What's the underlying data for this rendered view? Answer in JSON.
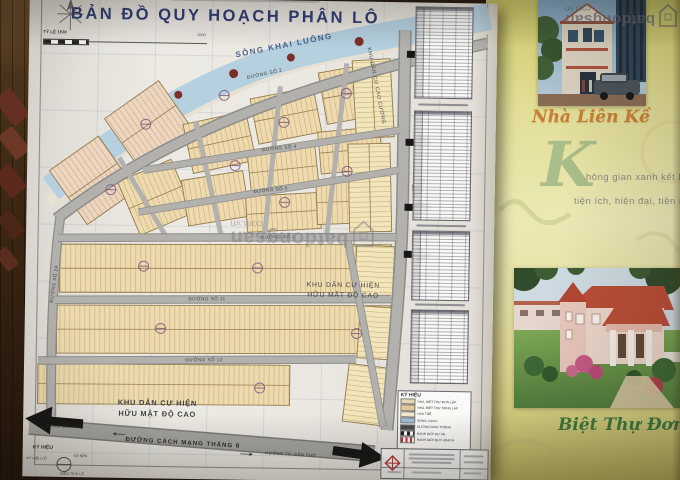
{
  "photo": {
    "watermark": {
      "brand": "batdongsan",
      "domain": "com.vn"
    }
  },
  "map": {
    "title": "BẢN ĐỒ QUY HOẠCH PHÂN LÔ",
    "scale_label": "TỶ LỆ 1KM",
    "scale_end": "1000",
    "river_label": "SÔNG KHAI LUÔNG",
    "roads": {
      "r2": "ĐƯỜNG SỐ 2",
      "r4": "ĐƯỜNG SỐ 4",
      "r5": "ĐƯỜNG SỐ 5",
      "r1": "ĐƯỜNG SỐ 1",
      "r11": "ĐƯỜNG SỐ 11",
      "r12": "ĐƯỜNG SỐ 12",
      "r2a": "ĐƯỜNG SỐ 2A",
      "cmt8": "ĐƯỜNG CÁCH MẠNG THÁNG 8"
    },
    "areas": {
      "cao_cuong": "KHU DÂN CƯ CAO CƯỜNG",
      "existing_line1": "KHU DÂN CƯ HIỆN",
      "existing_line2": "HỮU MẬT ĐỘ CAO"
    },
    "directions": {
      "port": "CẢNG CẦN THƠ",
      "port_arrow": "←",
      "city_arrow": "→",
      "city": "HƯỚNG TP. CẦN THƠ"
    },
    "legend": {
      "title": "KÝ HIỆU",
      "items": [
        {
          "label": "NHÀ, BIỆT THỰ ĐƠN LẬP",
          "color": "#e9d9b2"
        },
        {
          "label": "NHÀ, BIỆT THỰ SONG LẬP",
          "color": "#e2ca95"
        },
        {
          "label": "NHÀ TRẺ",
          "color": "#f3ecca"
        },
        {
          "label": "SÔNG, RẠCH",
          "color": "#9fc0d8"
        },
        {
          "label": "ĐƯỜNG GIAO THÔNG",
          "color": "#4a4a4a"
        },
        {
          "label": "RANH GIỚI DỰ ÁN",
          "color": "#222222"
        },
        {
          "label": "RANH GIỚI QUY HOẠCH",
          "color": "#c03030"
        }
      ]
    },
    "mini_legend": {
      "title": "KÝ HIỆU",
      "lot_code": "KÝ HIỆU LÔ",
      "lot_count": "SỐ NỀN",
      "lot_area": "DIỆN TÍCH LÔ"
    },
    "colors": {
      "title_text": "#2d3a78",
      "parcel_tan": "#f1dcab",
      "parcel_pink": "#f1d7bf",
      "river": "#b5d2e2",
      "road": "#b4b2ae"
    }
  },
  "brochure": {
    "card1_title": "Nhà Liên Kề",
    "drop_cap": "K",
    "tagline_line1": "hông gian xanh kết hợp hài hòa",
    "tagline_line2": "tiện ích, hiện đại, tiện nghi và gầ",
    "card2_title": "Biệt Thự Đơn L",
    "colors": {
      "card1_title": "#cf7f2e",
      "card2_title": "#3a7a3c"
    }
  }
}
